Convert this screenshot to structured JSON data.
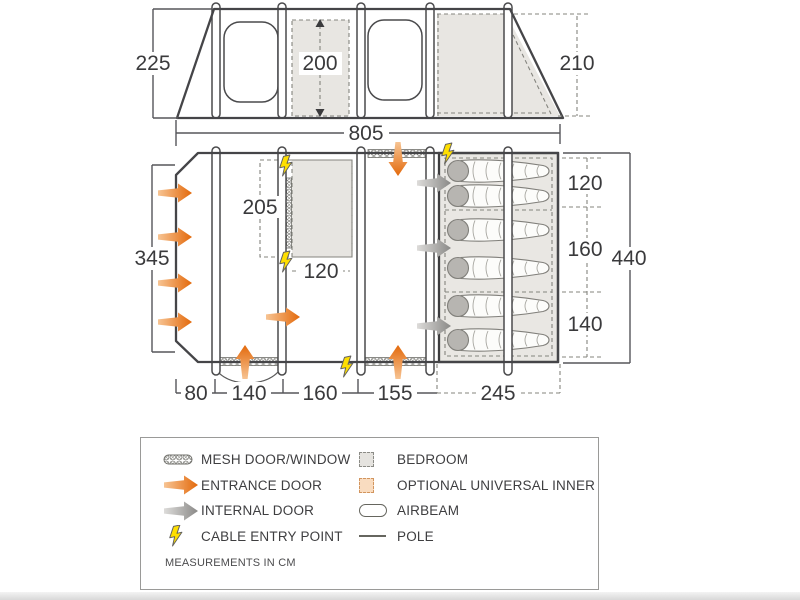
{
  "title": "tent-floorplan-diagram",
  "dims": {
    "elevation_height_left": "225",
    "elevation_height_center": "200",
    "elevation_height_right": "210",
    "total_width": "805",
    "plan_left_height": "345",
    "bedroom_left_height": "205",
    "bedroom_left_width": "120",
    "berth_top": "120",
    "berth_middle": "160",
    "berth_bottom": "140",
    "plan_total_height": "440",
    "bottom_1": "80",
    "bottom_2": "140",
    "bottom_3": "160",
    "bottom_4": "155",
    "bottom_5": "245"
  },
  "legend": {
    "left": [
      {
        "icon": "mesh-icon",
        "label": "MESH DOOR/WINDOW"
      },
      {
        "icon": "entrance-door-icon",
        "label": "ENTRANCE DOOR"
      },
      {
        "icon": "internal-door-icon",
        "label": "INTERNAL DOOR"
      },
      {
        "icon": "cable-entry-icon",
        "label": "CABLE ENTRY POINT"
      }
    ],
    "right": [
      {
        "icon": "bedroom-icon",
        "label": "BEDROOM"
      },
      {
        "icon": "optional-inner-icon",
        "label": "OPTIONAL UNIVERSAL INNER"
      },
      {
        "icon": "airbeam-icon",
        "label": "AIRBEAM"
      },
      {
        "icon": "pole-icon",
        "label": "POLE"
      }
    ],
    "note": "MEASUREMENTS IN CM"
  },
  "colors": {
    "accent_orange": "#e3690b",
    "internal_gray": "#8a8987",
    "cable_yellow": "#ffdf00",
    "shade_gray": "#e8e6e2",
    "optional_inner_peach": "#f9dcc0",
    "outline": "#454548"
  }
}
